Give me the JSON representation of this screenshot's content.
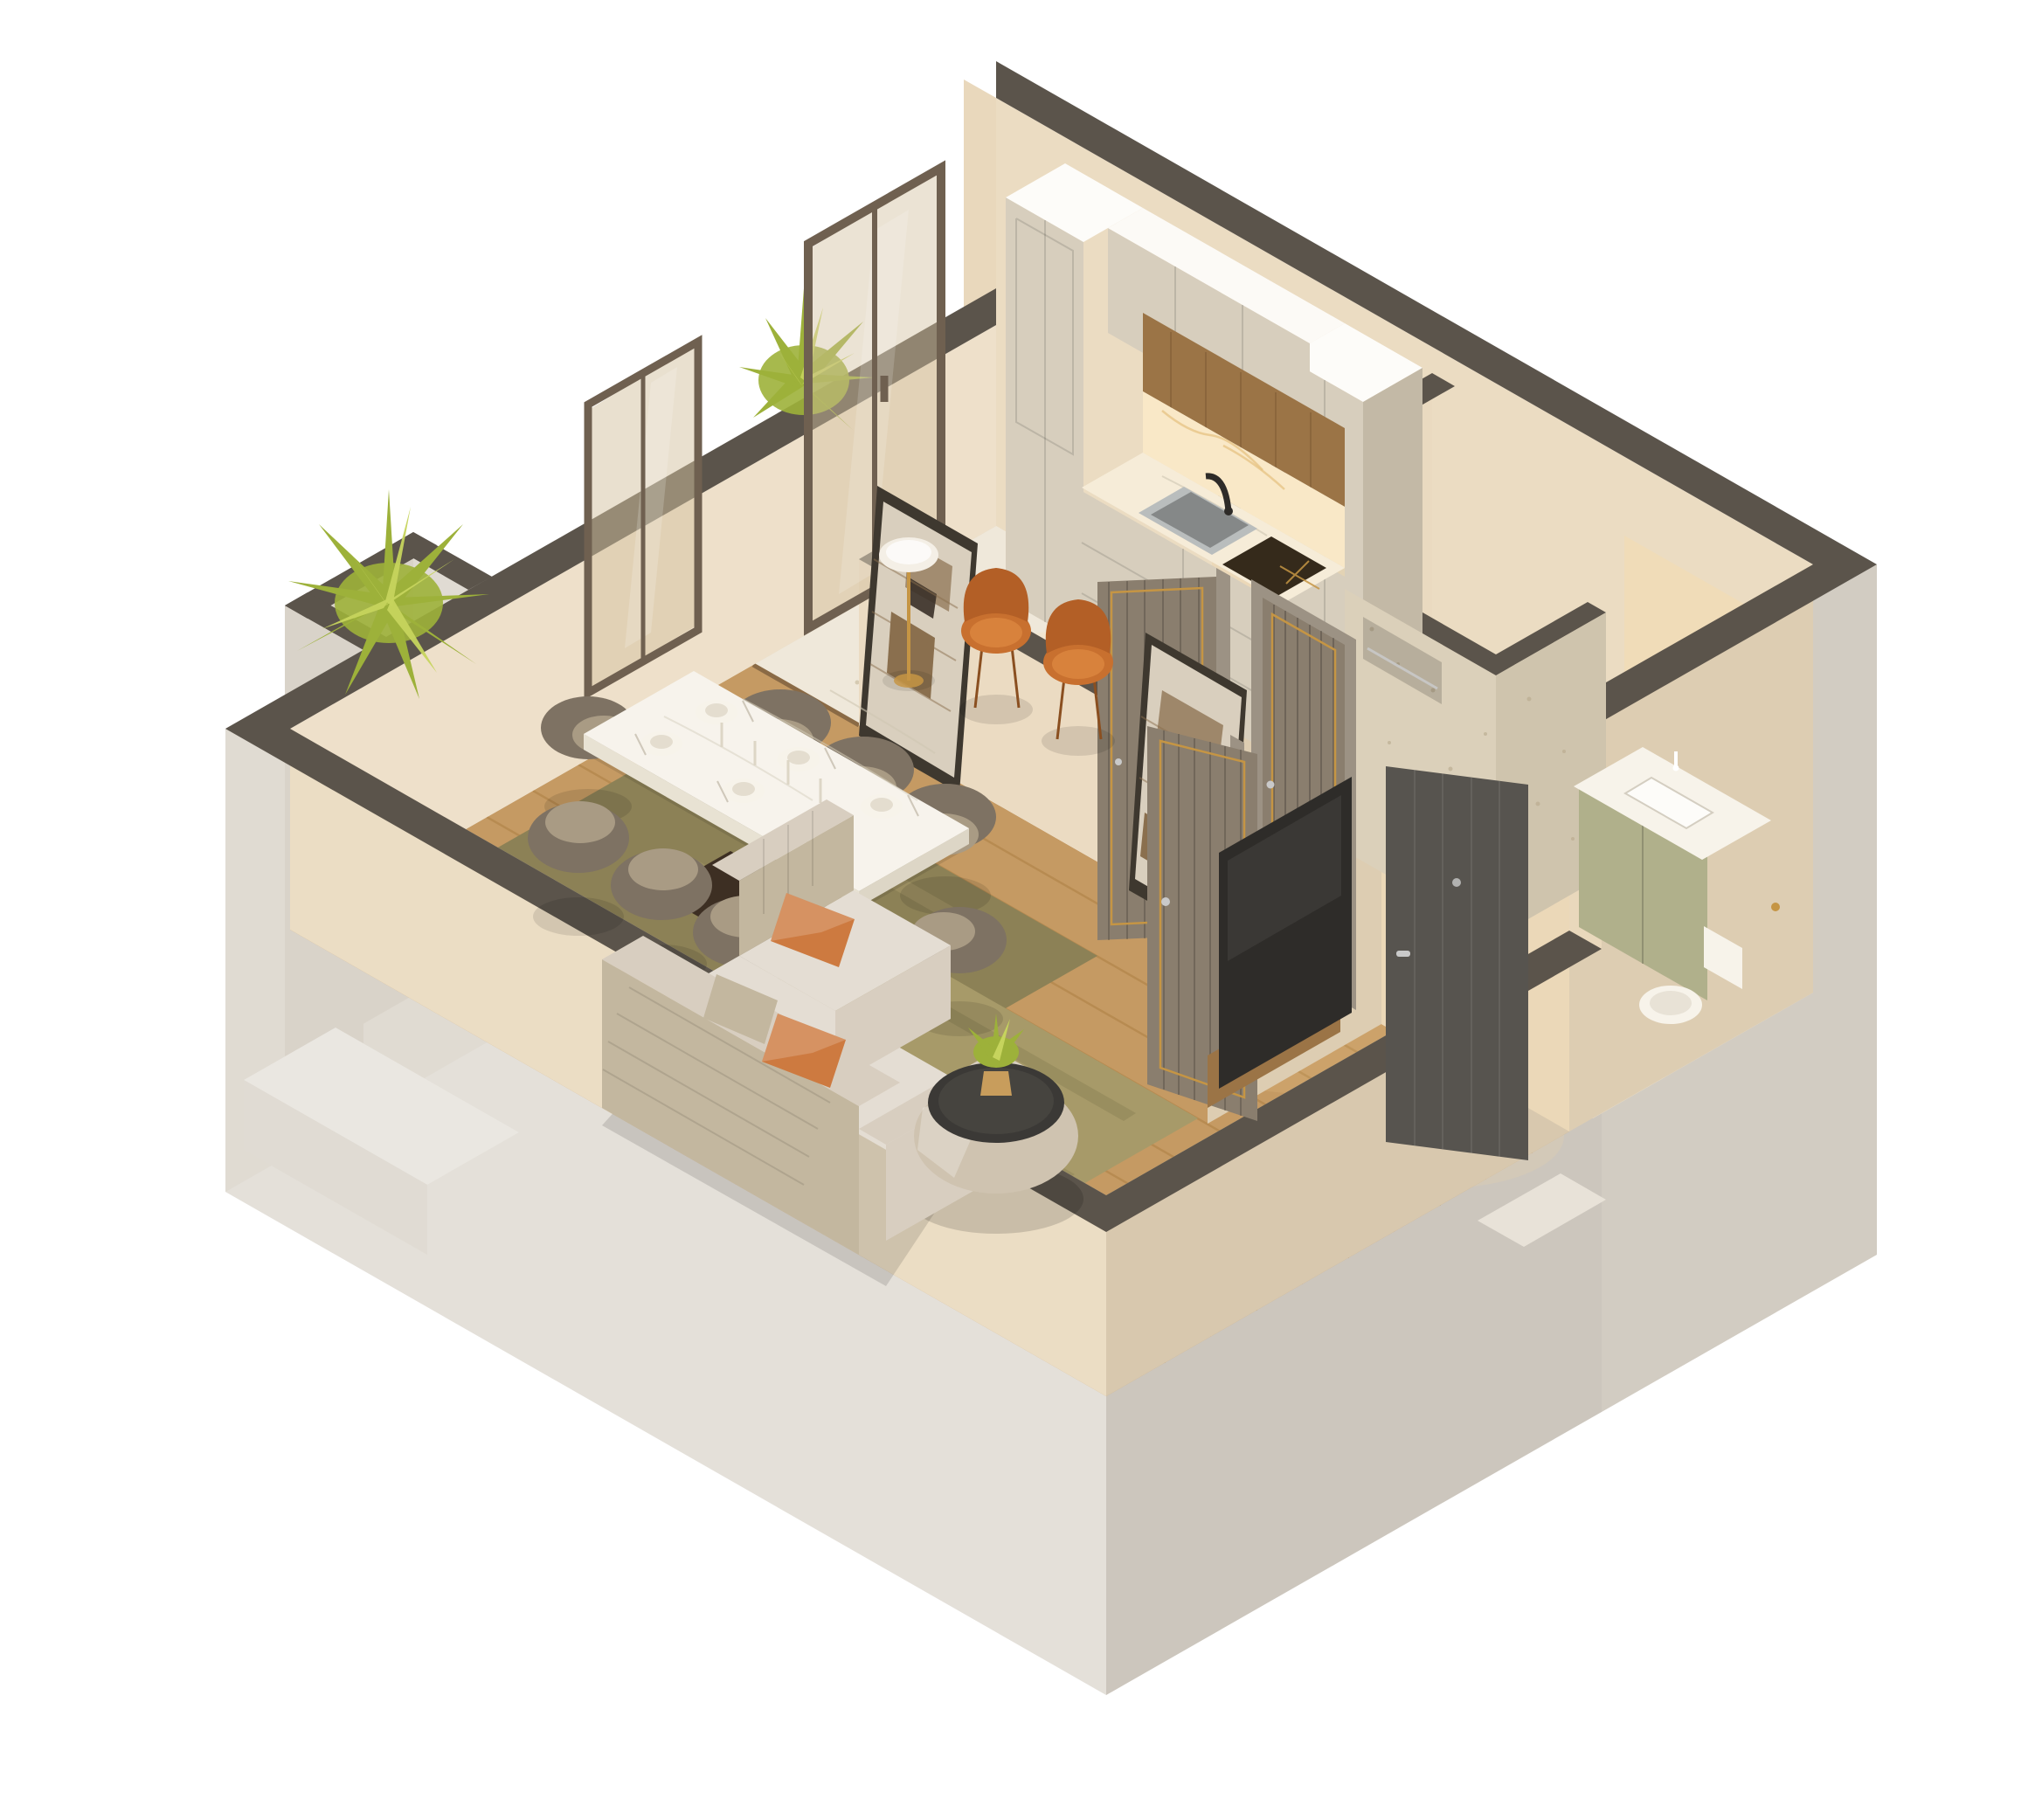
{
  "meta": {
    "type": "3d-isometric-floor-plan-render",
    "view": "dollhouse cutaway axonometric",
    "description": "Photoreal 3D cutaway render of a one-bedroom apartment: open kitchen with beige cabinetry and marble counter, living-dining room with 8-seat dining table, L-shaped sofa with orange pillows, round ottoman coffee table, bathroom with travertine shower and green vanity, fluted interior doors with gold trim, entry hall with open front door, plants at windows."
  },
  "colors": {
    "background": "#ffffff",
    "wall_top": "#5b544b",
    "wall_exterior": "#d9d3c9",
    "wall_interior": "#e9d8bc",
    "floor_wood": "#c59a63",
    "floor_plank_line": "#a8793d",
    "floor_terrazzo": "#efe8da",
    "floor_bath": "#ecdfc8",
    "rug_olive": "#8c8156",
    "rug_olive_light": "#a79a69",
    "cabinet_beige": "#d7cebd",
    "cabinet_side": "#c3b9a6",
    "wood_panel": "#9b7446",
    "marble": "#f6ecd8",
    "counter_sink": "#b9bdbd",
    "faucet_black": "#2e2b28",
    "cooktop": "#352a1b",
    "travertine": "#dbd0ba",
    "travertine_side": "#cfc4ad",
    "vanity_green": "#a6a67c",
    "porcelain_white": "#f7f3ea",
    "door_fluted": "#8a7e6e",
    "door_frame": "#9c9284",
    "door_entry": "#57544f",
    "gold": "#c59544",
    "silver": "#c9c9c9",
    "sofa_base": "#d8cec0",
    "sofa_texture": "#c3b79f",
    "pillow_orange": "#cd7a40",
    "chair_taupe": "#7e7263",
    "chair_taupe_light": "#a99b84",
    "chair_orange": "#c8702f",
    "table_white": "#f4efe6",
    "table_base": "#3d2f23",
    "ottoman_body": "#cfc3b0",
    "ottoman_top": "#3b3936",
    "plant_green": "#9db13a",
    "plant_green_light": "#c6d45d",
    "pot_wicker": "#c89d5c",
    "tv_black": "#2e2c29",
    "glass_tint": "#d3c2a0",
    "window_bronze": "#6f6050",
    "art_frame": "#3e382f",
    "art_paper": "#d9cfbe",
    "art_brown": "#8a6f4e"
  },
  "scene": {
    "rooms": [
      {
        "name": "Living & Dining Room",
        "floor": "wood planks",
        "items": [
          "marble dining table",
          "8 taupe tub chairs",
          "6 place settings with plates, napkins, glasses and cutlery",
          "L-shaped beige sofa",
          "orange accent pillows",
          "round ottoman coffee table with potted plant",
          "two olive area rugs",
          "two abstract framed artworks",
          "wall TV with wood media console"
        ]
      },
      {
        "name": "Kitchen",
        "floor": "white terrazzo",
        "items": [
          "two tall cabinet columns",
          "upper cabinets",
          "oak panel band",
          "marble backsplash and counter",
          "undermount grey sink",
          "black gooseneck faucet",
          "dark induction cooktop with gold marks",
          "two orange chairs",
          "small white bistro table",
          "bronze-framed glass slider with balcony plant"
        ]
      },
      {
        "name": "Bathroom",
        "floor": "beige stone",
        "items": [
          "travertine walk-in shower with niche and chrome bar",
          "green double-door vanity with white basin and faucet",
          "white toilet with gold paper holder"
        ]
      },
      {
        "name": "Entry Hall",
        "floor": "wood planks",
        "items": [
          "dark grey entry door, open, with chrome handle and peephole",
          "fluted grey interior doors with gold trim"
        ]
      }
    ],
    "exterior": [
      "cutaway walls with dark grey tops",
      "greige outer walls",
      "bronze-framed window",
      "corner planter nook with yellow-green fern",
      "white terrace slab"
    ]
  }
}
